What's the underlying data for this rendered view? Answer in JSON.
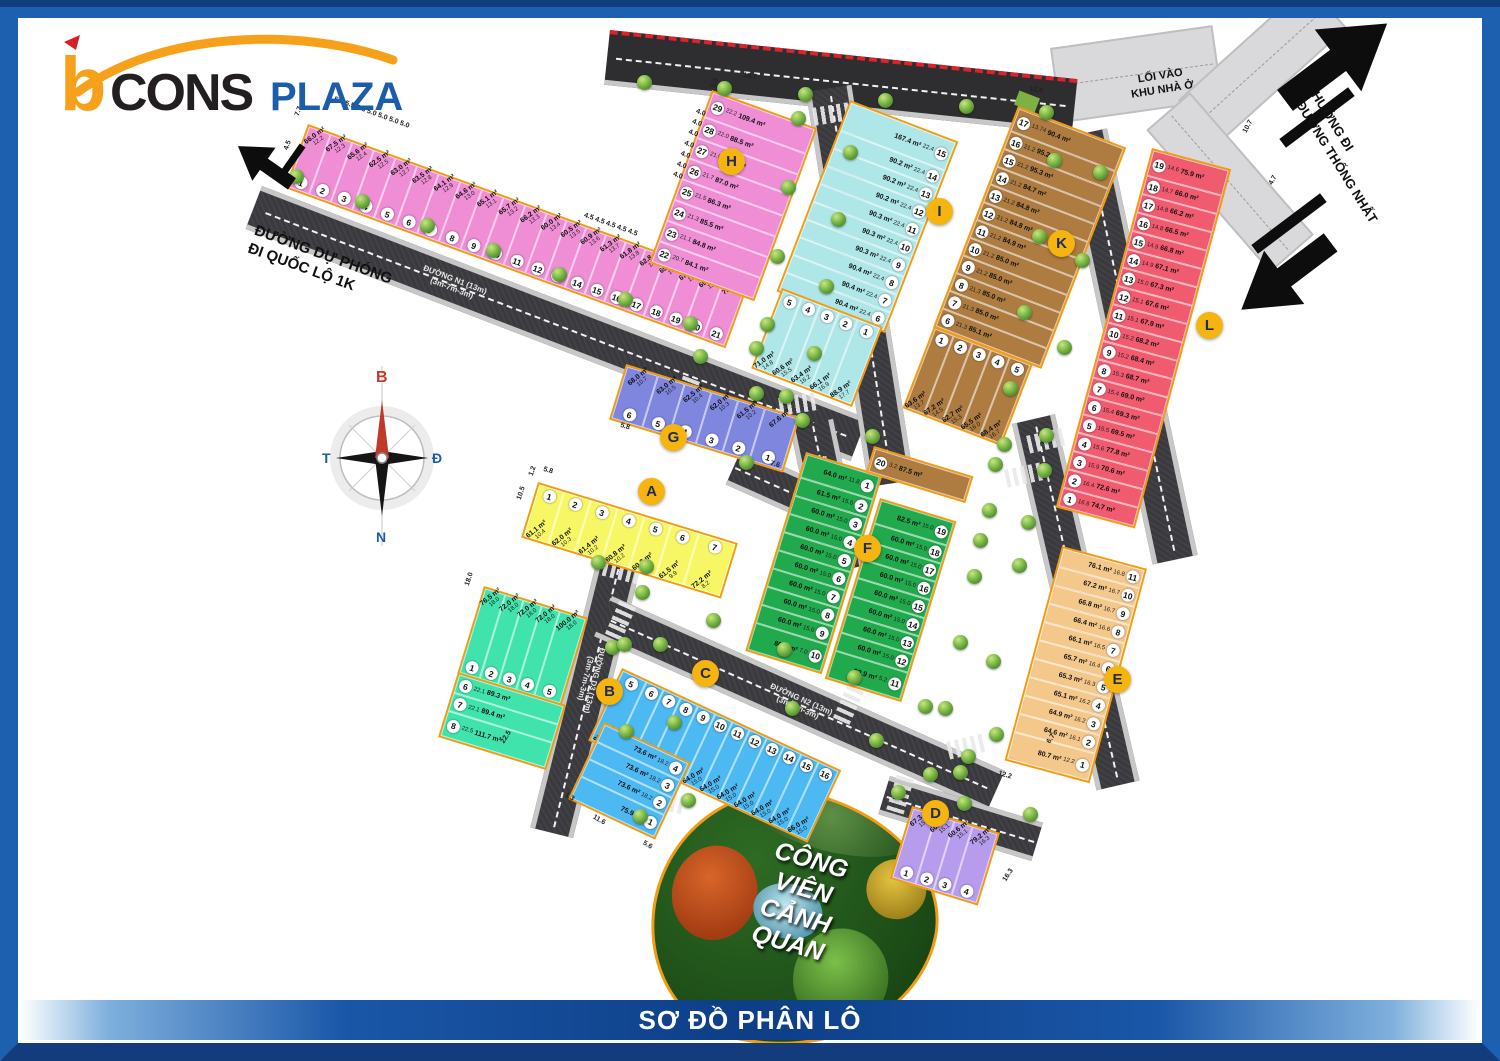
{
  "logo": {
    "b": "b",
    "cons": "CONS",
    "plaza": "PLAZA"
  },
  "title_bar": "SƠ ĐỒ PHÂN LÔ",
  "compass": {
    "north": "B",
    "east": "Đ",
    "south": "N",
    "west": "T"
  },
  "labels": {
    "road_du_phong": "ĐƯỜNG DỰ PHÓNG\nĐI QUỐC LỘ 1K",
    "entrance": "LỐI VÀO\nKHU NHÀ Ở",
    "direction": "HƯỚNG ĐI\nĐƯỜNG THỐNG NHẤT",
    "park": "CÔNG VIÊN\nCẢNH QUAN"
  },
  "roads": [
    {
      "id": "n1",
      "name": "ĐƯỜNG N1 (13m)",
      "spec": "(3m-7m-3m)"
    },
    {
      "id": "n2",
      "name": "ĐƯỜNG N2 (13m)",
      "spec": "(3m-7m-3m)"
    },
    {
      "id": "d1",
      "name": "ĐƯỜNG D1 (13m)",
      "spec": "(3m-7m-3m)"
    },
    {
      "id": "d2",
      "name": "ĐƯỜNG D2 (13m)",
      "spec": "(3m-7m-3m)"
    },
    {
      "id": "d2b",
      "name": "ĐƯỜNG D2 (13m)",
      "spec": "(3m-7m-3m)"
    },
    {
      "id": "d3",
      "name": "ĐƯỜNG D3 (13m)",
      "spec": "(3m-7m-3m)"
    },
    {
      "id": "d4",
      "name": "ĐƯỜNG D4 (13m)",
      "spec": "(3m-7m-3m)"
    }
  ],
  "area_unit": "m²",
  "blocks": [
    {
      "label": "A",
      "color": "#f7f766",
      "lots": [
        {
          "n": 1,
          "a": "61.1",
          "d": "10.4"
        },
        {
          "n": 2,
          "a": "62.0",
          "d": "10.3"
        },
        {
          "n": 3,
          "a": "61.4",
          "d": "10.2"
        },
        {
          "n": 4,
          "a": "60.8",
          "d": "10.2"
        },
        {
          "n": 5,
          "a": "60.2",
          "d": "10.0"
        },
        {
          "n": 6,
          "a": "61.5",
          "d": "9.9"
        },
        {
          "n": 7,
          "a": "72.2",
          "d": "8.2"
        }
      ]
    },
    {
      "label": "B",
      "color": "#40e3ac",
      "lots": [
        {
          "n": 1,
          "a": "76.5",
          "d": "18.0"
        },
        {
          "n": 2,
          "a": "72.0",
          "d": "18.0"
        },
        {
          "n": 3,
          "a": "72.0",
          "d": "18.0"
        },
        {
          "n": 4,
          "a": "72.0",
          "d": "18.0"
        },
        {
          "n": 5,
          "a": "100.0",
          "d": "18.0"
        },
        {
          "n": 6,
          "a": "89.3",
          "d": "22.1"
        },
        {
          "n": 7,
          "a": "89.4",
          "d": "22.1"
        },
        {
          "n": 8,
          "a": "111.7",
          "d": "22.5"
        }
      ]
    },
    {
      "label": "C",
      "color": "#4cb9f2",
      "lots": [
        {
          "n": 1,
          "a": "75.9",
          "d": ""
        },
        {
          "n": 2,
          "a": "73.6",
          "d": "18.2"
        },
        {
          "n": 3,
          "a": "73.6",
          "d": "18.2"
        },
        {
          "n": 4,
          "a": "73.6",
          "d": "18.2"
        },
        {
          "n": 5,
          "a": "95.3",
          "d": "15.8"
        },
        {
          "n": 6,
          "a": "63.2",
          "d": "16.0"
        },
        {
          "n": 7,
          "a": "63.2",
          "d": "16.0"
        },
        {
          "n": 8,
          "a": "63.2",
          "d": "16.0"
        },
        {
          "n": 9,
          "a": "63.8",
          "d": "16.0"
        },
        {
          "n": 10,
          "a": "64.0",
          "d": "15.0"
        },
        {
          "n": 11,
          "a": "64.0",
          "d": "15.0"
        },
        {
          "n": 12,
          "a": "64.0",
          "d": "15.0"
        },
        {
          "n": 13,
          "a": "64.0",
          "d": "15.0"
        },
        {
          "n": 14,
          "a": "64.0",
          "d": "15.0"
        },
        {
          "n": 15,
          "a": "64.0",
          "d": "15.0"
        },
        {
          "n": 16,
          "a": "66.0",
          "d": "15.0"
        }
      ]
    },
    {
      "label": "D",
      "color": "#b79bec",
      "lots": [
        {
          "n": 1,
          "a": "67.3",
          "d": "15.1"
        },
        {
          "n": 2,
          "a": "60.6",
          "d": "15.1"
        },
        {
          "n": 3,
          "a": "60.6",
          "d": "15.1"
        },
        {
          "n": 4,
          "a": "79.2",
          "d": "16.3"
        }
      ]
    },
    {
      "label": "E",
      "color": "#f4c78b",
      "lots": [
        {
          "n": 1,
          "a": "80.7",
          "d": "12.2"
        },
        {
          "n": 2,
          "a": "64.6",
          "d": "16.1"
        },
        {
          "n": 3,
          "a": "64.9",
          "d": "16.2"
        },
        {
          "n": 4,
          "a": "65.1",
          "d": "16.2"
        },
        {
          "n": 5,
          "a": "65.3",
          "d": "16.3"
        },
        {
          "n": 6,
          "a": "65.7",
          "d": "16.4"
        },
        {
          "n": 7,
          "a": "66.1",
          "d": "16.5"
        },
        {
          "n": 8,
          "a": "66.4",
          "d": "16.6"
        },
        {
          "n": 9,
          "a": "66.8",
          "d": "16.7"
        },
        {
          "n": 10,
          "a": "67.2",
          "d": "16.7"
        },
        {
          "n": 11,
          "a": "76.1",
          "d": "16.8"
        }
      ]
    },
    {
      "label": "F",
      "color": "#21a94d",
      "lots": [
        {
          "n": 1,
          "a": "64.0",
          "d": "11.8"
        },
        {
          "n": 2,
          "a": "61.5",
          "d": "15.0"
        },
        {
          "n": 3,
          "a": "60.0",
          "d": "15.0"
        },
        {
          "n": 4,
          "a": "60.0",
          "d": "15.0"
        },
        {
          "n": 5,
          "a": "60.0",
          "d": "15.0"
        },
        {
          "n": 6,
          "a": "60.0",
          "d": "15.0"
        },
        {
          "n": 7,
          "a": "60.0",
          "d": "15.0"
        },
        {
          "n": 8,
          "a": "60.0",
          "d": "15.0"
        },
        {
          "n": 9,
          "a": "60.0",
          "d": "15.0"
        },
        {
          "n": 10,
          "a": "80.4",
          "d": "7.0"
        },
        {
          "n": 11,
          "a": "90.9",
          "d": "5.2"
        },
        {
          "n": 12,
          "a": "60.0",
          "d": "15.0"
        },
        {
          "n": 13,
          "a": "60.0",
          "d": "15.0"
        },
        {
          "n": 14,
          "a": "60.0",
          "d": "15.0"
        },
        {
          "n": 15,
          "a": "60.0",
          "d": "15.0"
        },
        {
          "n": 16,
          "a": "60.0",
          "d": "15.0"
        },
        {
          "n": 17,
          "a": "60.0",
          "d": "15.0"
        },
        {
          "n": 18,
          "a": "60.0",
          "d": "15.0"
        },
        {
          "n": 19,
          "a": "82.5",
          "d": "15.0"
        },
        {
          "n": 20,
          "a": "87.5",
          "d": "3.2",
          "c": "#ae7c41"
        }
      ]
    },
    {
      "label": "G",
      "color": "#7f86de",
      "lots": [
        {
          "n": 1,
          "a": "67.6",
          "d": ""
        },
        {
          "n": 2,
          "a": "61.5",
          "d": "10.2"
        },
        {
          "n": 3,
          "a": "62.0",
          "d": "10.3"
        },
        {
          "n": 4,
          "a": "62.5",
          "d": "10.4"
        },
        {
          "n": 5,
          "a": "63.0",
          "d": "10.5"
        },
        {
          "n": 6,
          "a": "68.0",
          "d": "10.7"
        }
      ]
    },
    {
      "label": "H",
      "color": "#ef8ed5",
      "lots": [
        {
          "n": 1,
          "a": "66.0",
          "d": "12.2"
        },
        {
          "n": 2,
          "a": "67.5",
          "d": "12.3"
        },
        {
          "n": 3,
          "a": "65.6",
          "d": "12.4"
        },
        {
          "n": 4,
          "a": "62.5",
          "d": "12.5"
        },
        {
          "n": 5,
          "a": "63.0",
          "d": "12.7"
        },
        {
          "n": 6,
          "a": "63.5",
          "d": "12.8"
        },
        {
          "n": 7,
          "a": "64.1",
          "d": "12.9"
        },
        {
          "n": 8,
          "a": "64.6",
          "d": "13.0"
        },
        {
          "n": 9,
          "a": "65.1",
          "d": "13.1"
        },
        {
          "n": 10,
          "a": "65.7",
          "d": "13.2"
        },
        {
          "n": 11,
          "a": "66.2",
          "d": "13.3"
        },
        {
          "n": 12,
          "a": "60.0",
          "d": "13.4"
        },
        {
          "n": 13,
          "a": "60.5",
          "d": "13.5"
        },
        {
          "n": 14,
          "a": "60.9",
          "d": "13.6"
        },
        {
          "n": 15,
          "a": "61.3",
          "d": "13.7"
        },
        {
          "n": 16,
          "a": "61.8",
          "d": "13.8"
        },
        {
          "n": 17,
          "a": "62.8",
          "d": "14.2"
        },
        {
          "n": 18,
          "a": "65.1",
          "d": "14.7"
        },
        {
          "n": 19,
          "a": "67.4",
          "d": "15.2"
        },
        {
          "n": 20,
          "a": "69.6",
          "d": "15.7"
        },
        {
          "n": 21,
          "a": "78.9",
          "d": ""
        },
        {
          "n": 22,
          "a": "84.1",
          "d": "20.7"
        },
        {
          "n": 23,
          "a": "84.8",
          "d": "21.1"
        },
        {
          "n": 24,
          "a": "85.5",
          "d": "21.3"
        },
        {
          "n": 25,
          "a": "86.3",
          "d": "21.5"
        },
        {
          "n": 26,
          "a": "87.0",
          "d": "21.7"
        },
        {
          "n": 27,
          "a": "87.8",
          "d": "21.9"
        },
        {
          "n": 28,
          "a": "88.5",
          "d": "22.0"
        },
        {
          "n": 29,
          "a": "109.4",
          "d": "22.2"
        }
      ]
    },
    {
      "label": "I",
      "color": "#afe6e7",
      "lots": [
        {
          "n": 1,
          "a": "88.9",
          "d": "17.7"
        },
        {
          "n": 2,
          "a": "66.1",
          "d": "16.9"
        },
        {
          "n": 3,
          "a": "63.4",
          "d": "16.2"
        },
        {
          "n": 4,
          "a": "60.6",
          "d": "15.5"
        },
        {
          "n": 5,
          "a": "71.0",
          "d": "14.8"
        },
        {
          "n": 6,
          "a": "90.4",
          "d": "22.4"
        },
        {
          "n": 7,
          "a": "90.4",
          "d": "22.4"
        },
        {
          "n": 8,
          "a": "90.4",
          "d": "22.4"
        },
        {
          "n": 9,
          "a": "90.3",
          "d": "22.4"
        },
        {
          "n": 10,
          "a": "90.3",
          "d": "22.4"
        },
        {
          "n": 11,
          "a": "90.3",
          "d": "22.4"
        },
        {
          "n": 12,
          "a": "90.2",
          "d": "22.4"
        },
        {
          "n": 13,
          "a": "90.2",
          "d": "22.4"
        },
        {
          "n": 14,
          "a": "90.2",
          "d": "22.4"
        },
        {
          "n": 15,
          "a": "167.4",
          "d": "22.4"
        }
      ]
    },
    {
      "label": "K",
      "color": "#ae7c41",
      "lots": [
        {
          "n": 1,
          "a": "63.6",
          "d": "13.7"
        },
        {
          "n": 2,
          "a": "67.2",
          "d": "14.5"
        },
        {
          "n": 3,
          "a": "62.7",
          "d": "15.3"
        },
        {
          "n": 4,
          "a": "65.5",
          "d": "16.0"
        },
        {
          "n": 5,
          "a": "68.4",
          "d": "16.7"
        },
        {
          "n": 6,
          "a": "85.1",
          "d": "21.3"
        },
        {
          "n": 7,
          "a": "85.0",
          "d": "21.3"
        },
        {
          "n": 8,
          "a": "85.0",
          "d": "21.3"
        },
        {
          "n": 9,
          "a": "85.0",
          "d": "21.2"
        },
        {
          "n": 10,
          "a": "85.0",
          "d": "21.2"
        },
        {
          "n": 11,
          "a": "84.9",
          "d": "21.2"
        },
        {
          "n": 12,
          "a": "84.8",
          "d": "21.2"
        },
        {
          "n": 13,
          "a": "84.8",
          "d": "21.2"
        },
        {
          "n": 14,
          "a": "84.7",
          "d": "21.2"
        },
        {
          "n": 15,
          "a": "95.3",
          "d": "21.2"
        },
        {
          "n": 16,
          "a": "95.2",
          "d": "21.2"
        },
        {
          "n": 17,
          "a": "90.4",
          "d": "13.74"
        }
      ]
    },
    {
      "label": "L",
      "color": "#f15b70",
      "lots": [
        {
          "n": 1,
          "a": "74.7",
          "d": "16.8"
        },
        {
          "n": 2,
          "a": "72.6",
          "d": "16.4"
        },
        {
          "n": 3,
          "a": "70.6",
          "d": "15.9"
        },
        {
          "n": 4,
          "a": "77.8",
          "d": "15.6"
        },
        {
          "n": 5,
          "a": "69.5",
          "d": "15.5"
        },
        {
          "n": 6,
          "a": "69.3",
          "d": "15.4"
        },
        {
          "n": 7,
          "a": "69.0",
          "d": "15.4"
        },
        {
          "n": 8,
          "a": "68.7",
          "d": "15.3"
        },
        {
          "n": 9,
          "a": "68.4",
          "d": "15.2"
        },
        {
          "n": 10,
          "a": "68.2",
          "d": "15.2"
        },
        {
          "n": 11,
          "a": "67.9",
          "d": "15.1"
        },
        {
          "n": 12,
          "a": "67.6",
          "d": "15.1"
        },
        {
          "n": 13,
          "a": "67.3",
          "d": "15.0"
        },
        {
          "n": 14,
          "a": "67.1",
          "d": "14.9"
        },
        {
          "n": 15,
          "a": "66.8",
          "d": "14.9"
        },
        {
          "n": 16,
          "a": "66.5",
          "d": "14.8"
        },
        {
          "n": 17,
          "a": "66.2",
          "d": "14.8"
        },
        {
          "n": 18,
          "a": "66.0",
          "d": "14.7"
        },
        {
          "n": 19,
          "a": "75.9",
          "d": "14.6"
        }
      ]
    }
  ],
  "edge_dims": [
    {
      "t": "5.6   5.5   5.3   5.0   5.0   5.0   5.0",
      "x": 336,
      "y": 94,
      "r": 20
    },
    {
      "t": "4.5   4.5   4.5   4.5   4.5",
      "x": 586,
      "y": 210,
      "r": 20
    },
    {
      "t": "7.7",
      "x": 292,
      "y": 114,
      "r": -70
    },
    {
      "t": "4.5",
      "x": 281,
      "y": 148,
      "r": -70
    },
    {
      "t": "3.3",
      "x": 708,
      "y": 86,
      "r": -70
    },
    {
      "t": "4.0\n4.0\n4.0\n4.0\n4.0\n4.0\n4.0",
      "x": 698,
      "y": 106,
      "r": 20
    },
    {
      "t": "18.7",
      "x": 744,
      "y": 70,
      "r": 8
    },
    {
      "t": "10.4",
      "x": 1030,
      "y": 84,
      "r": 8
    },
    {
      "t": "10.7",
      "x": 1240,
      "y": 130,
      "r": -62
    },
    {
      "t": "4.7",
      "x": 1266,
      "y": 182,
      "r": -62
    },
    {
      "t": "10.5",
      "x": 514,
      "y": 498,
      "r": -72
    },
    {
      "t": "1.2",
      "x": 526,
      "y": 474,
      "r": -72
    },
    {
      "t": "5.8",
      "x": 545,
      "y": 464,
      "r": 17
    },
    {
      "t": "18.0",
      "x": 462,
      "y": 584,
      "r": -72
    },
    {
      "t": "22.5",
      "x": 498,
      "y": 740,
      "r": -58
    },
    {
      "t": "1.3",
      "x": 568,
      "y": 790,
      "r": 30
    },
    {
      "t": "11.6",
      "x": 596,
      "y": 812,
      "r": 30
    },
    {
      "t": "5.6",
      "x": 646,
      "y": 838,
      "r": 30
    },
    {
      "t": "16.3",
      "x": 1000,
      "y": 878,
      "r": -58
    },
    {
      "t": "12.2",
      "x": 1000,
      "y": 768,
      "r": 17
    },
    {
      "t": "6.7",
      "x": 1044,
      "y": 740,
      "r": -58
    },
    {
      "t": "7.6",
      "x": 772,
      "y": 458,
      "r": 17
    },
    {
      "t": "5.8",
      "x": 622,
      "y": 420,
      "r": 17
    }
  ]
}
